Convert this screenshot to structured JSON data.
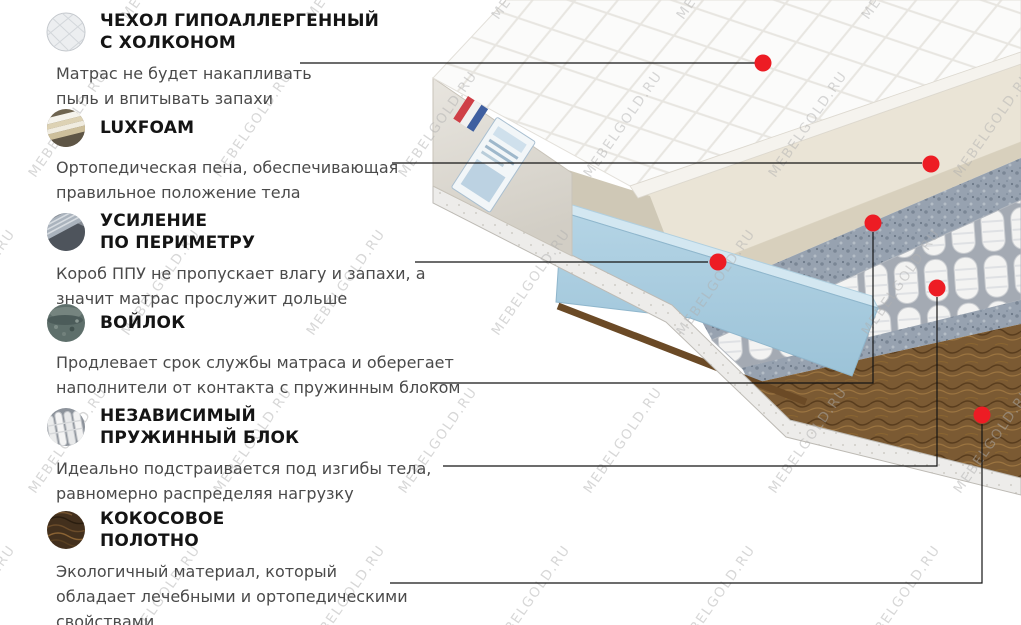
{
  "watermark": {
    "text": "MEBELGOLD.RU"
  },
  "colors": {
    "callout_dot": "#ed1c24",
    "callout_line": "#141414",
    "title_text": "#141414",
    "description_text": "#4a4a4a",
    "watermark_text": "#afafaf",
    "cover_white": "#fbfbfa",
    "foam_cream": "#eae4d6",
    "perimeter_blue": "#a9cde0",
    "felt_grey": "#97a2b0",
    "springs_white": "#f3f3f2",
    "coconut_brown": "#7b5a33",
    "side_panel_beige": "#dfdbd3"
  },
  "sections": [
    {
      "icon": "quilted-cover-icon",
      "title_line1": "ЧЕХОЛ ГИПОАЛЛЕРГЕННЫЙ",
      "title_line2": "С ХОЛКОНОМ",
      "desc_line1": "Матрас не будет накапливать",
      "desc_line2": "пыль и впитывать запахи",
      "desc_line3": ""
    },
    {
      "icon": "foam-layers-icon",
      "title_line1": "LUXFOAM",
      "title_line2": "",
      "desc_line1": "Ортопедическая пена, обеспечивающая",
      "desc_line2": "правильное положение тела",
      "desc_line3": ""
    },
    {
      "icon": "perimeter-foam-icon",
      "title_line1": "УСИЛЕНИЕ",
      "title_line2": "ПО ПЕРИМЕТРУ",
      "desc_line1": "Короб ППУ не пропускает влагу и запахи, а",
      "desc_line2": "значит матрас прослужит дольше",
      "desc_line3": ""
    },
    {
      "icon": "felt-icon",
      "title_line1": "ВОЙЛОК",
      "title_line2": "",
      "desc_line1": "Продлевает срок службы матраса  и оберегает",
      "desc_line2": "наполнители от контакта с пружинным блоком",
      "desc_line3": ""
    },
    {
      "icon": "pocket-springs-icon",
      "title_line1": "НЕЗАВИСИМЫЙ",
      "title_line2": "ПРУЖИННЫЙ БЛОК",
      "desc_line1": "Идеально подстраивается под изгибы тела,",
      "desc_line2": "равномерно распределяя нагрузку",
      "desc_line3": ""
    },
    {
      "icon": "coconut-coir-icon",
      "title_line1": "КОКОСОВОЕ",
      "title_line2": "ПОЛОТНО",
      "desc_line1": "Экологичный материал, который",
      "desc_line2": "обладает лечебными и ортопедическими",
      "desc_line3": "свойствами"
    }
  ]
}
